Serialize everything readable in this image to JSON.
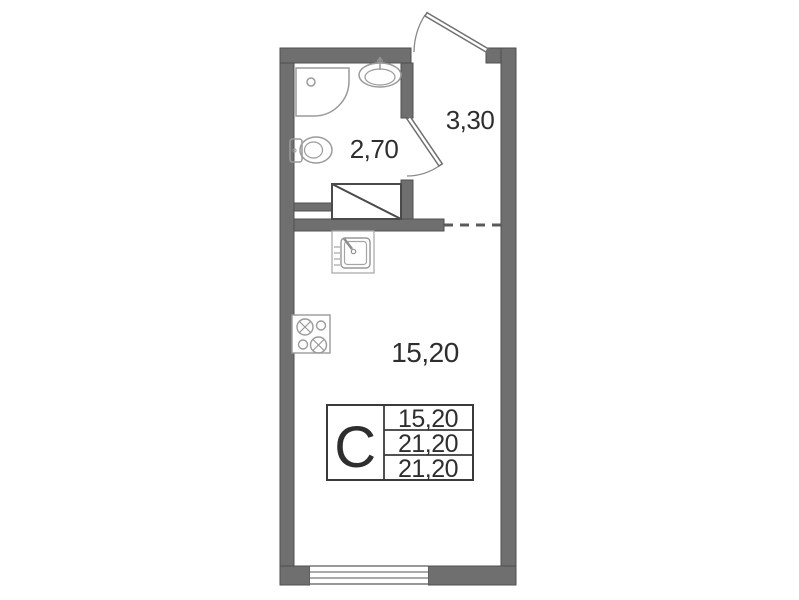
{
  "plan": {
    "title": "studio-apartment-floor-plan",
    "rooms": {
      "bathroom": {
        "area": "2,70"
      },
      "hall": {
        "area": "3,30"
      },
      "living": {
        "area": "15,20"
      }
    },
    "legend": {
      "type_letter": "С",
      "rows": [
        "15,20",
        "21,20",
        "21,20"
      ]
    },
    "icons": [
      "shower-tray-icon",
      "washbasin-icon",
      "toilet-icon",
      "kitchen-sink-icon",
      "stove-icon",
      "entrance-door-icon",
      "bathroom-door-icon",
      "wardrobe-icon",
      "window-icon",
      "dashed-boundary-icon"
    ],
    "colors": {
      "wall_fill": "#6f6f6f",
      "wall_edge": "#4f4f4f",
      "fixture_outline": "#999999",
      "dark_line": "#3a3a3a",
      "text": "#2e2e2e"
    }
  }
}
